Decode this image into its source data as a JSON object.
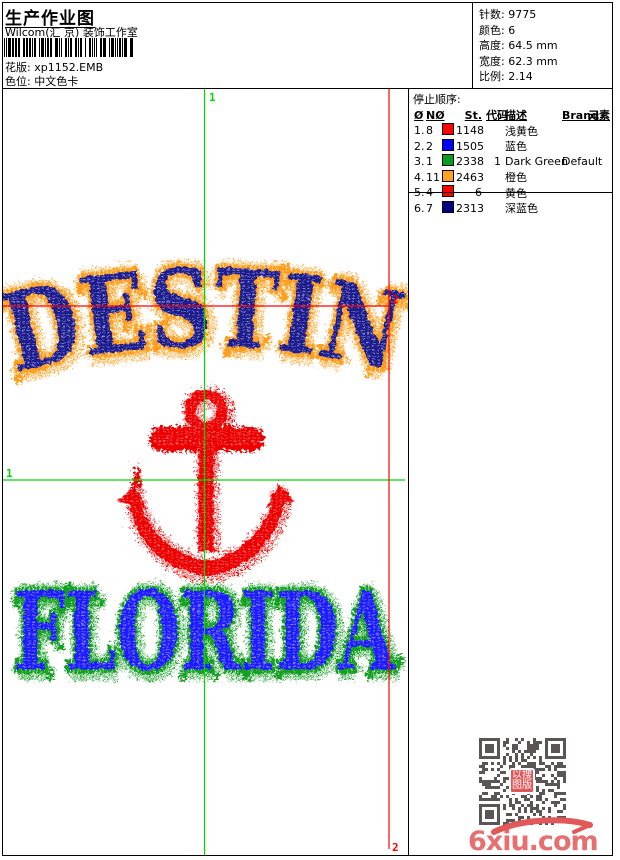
{
  "header": {
    "title": "生产作业图",
    "studio": "Wilcom(汇 京) 装饰工作室",
    "pattern": "花版: xp1152.EMB",
    "colorway": "色位: 中文色卡"
  },
  "stats": {
    "lines": [
      "针数: 9775",
      "颜色: 6",
      "高度: 64.5 mm",
      "宽度: 62.3 mm",
      "比例: 2.14"
    ]
  },
  "stop_sequence": {
    "title": "停止顺序:",
    "headers": {
      "stop": "Ø",
      "needle": "NØ",
      "st": "St.",
      "code": "代码",
      "desc": "描述",
      "brand": "Brand",
      "elem": "元素"
    },
    "rows": [
      {
        "stop": "1.",
        "needle": "8",
        "color": "#ff0000",
        "st": "1148",
        "code": "",
        "desc": "浅黄色",
        "brand": "",
        "elem": ""
      },
      {
        "stop": "2.",
        "needle": "2",
        "color": "#0000ff",
        "st": "1505",
        "code": "",
        "desc": "蓝色",
        "brand": "",
        "elem": ""
      },
      {
        "stop": "3.",
        "needle": "1",
        "color": "#00a01e",
        "st": "2338",
        "code": "1",
        "desc": "Dark Green",
        "brand": "Default",
        "elem": ""
      },
      {
        "stop": "4.",
        "needle": "11",
        "color": "#ffa01e",
        "st": "2463",
        "code": "",
        "desc": "橙色",
        "brand": "",
        "elem": ""
      },
      {
        "stop": "5.",
        "needle": "4",
        "color": "#ff0000",
        "st": "6",
        "code": "",
        "desc": "黄色",
        "brand": "",
        "elem": ""
      },
      {
        "stop": "6.",
        "needle": "7",
        "color": "#000080",
        "st": "2313",
        "code": "",
        "desc": "深蓝色",
        "brand": "",
        "elem": ""
      }
    ]
  },
  "design": {
    "top_text": "DESTIN",
    "bottom_text": "FLORIDA",
    "markers": {
      "green": "1",
      "red": "2"
    },
    "colors": {
      "top_fill": "#1c1c8f",
      "top_fringe": "#ff9e1c",
      "bottom_fill": "#1a1aff",
      "bottom_fringe": "#12a024",
      "anchor": "#ee0505",
      "guide_green": "#00d800",
      "guide_red": "#ff0000",
      "qr": "#5b5656"
    }
  },
  "qr": {
    "logo_lines": [
      "以搜",
      "图版"
    ]
  },
  "watermark": {
    "text": "6xiu.com",
    "color": "#e25757"
  }
}
